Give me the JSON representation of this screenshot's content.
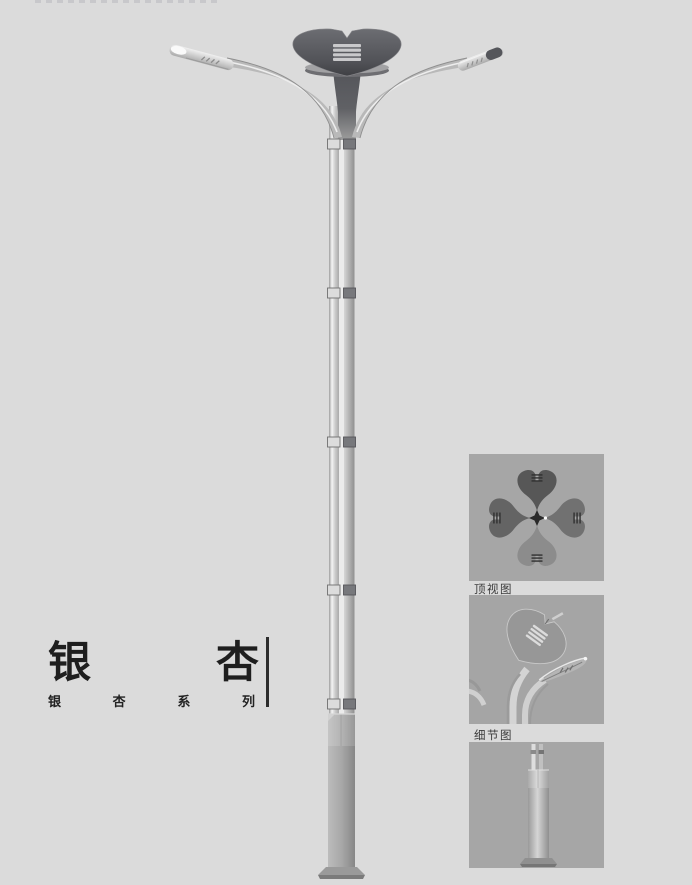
{
  "page": {
    "background": "#dbdbdb"
  },
  "title": {
    "main_chars": [
      "银",
      "杏"
    ],
    "main_text": "银杏",
    "series_chars": [
      "银",
      "杏",
      "系",
      "列"
    ],
    "series_text": "银杏系列"
  },
  "thumbnails": {
    "top_view_label": "顶视图",
    "detail_view_label": "细节图"
  },
  "colors": {
    "page_background": "#dbdbdb",
    "thumbnail_background": "#a6a6a6",
    "pole_light": "#cdcdcd",
    "pole_shadow": "#949494",
    "crown_dark": "#515257",
    "base_gray": "#8f8f8f",
    "title_text": "#1e1e1e",
    "label_text": "#3a3a3a",
    "divider": "#2c2c2c"
  }
}
